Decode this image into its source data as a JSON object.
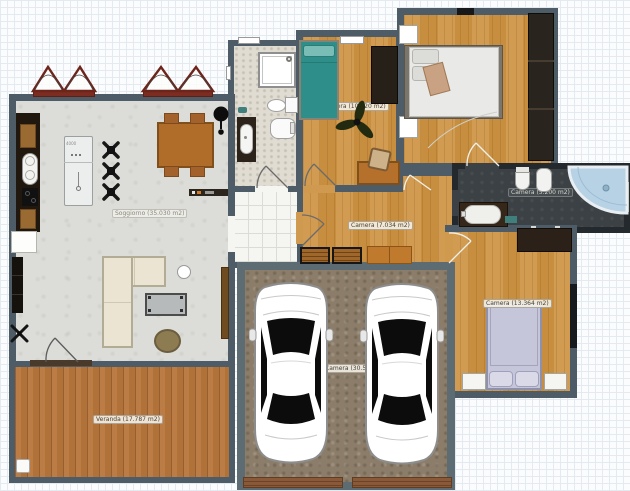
{
  "app": {
    "type": "floor-plan-canvas"
  },
  "labels": {
    "living": "Soggiorno (35.030 m2)",
    "veranda": "Veranda (17.787 m2)",
    "corridor": "Camera (7.034 m2)",
    "bedroom_middle": "Camera (10.020 m2)",
    "bathroom_main": "Camera (5.200 m2)",
    "bedroom_right": "Camera (13.364 m2)",
    "garage": "Camera (30.534 m2)",
    "island_dim": "4000"
  },
  "colors": {
    "wall": "#4d5c66",
    "wall_dark": "#23292c",
    "wall_garage": "#5d6b73",
    "floor_living": "#dcdcd8",
    "floor_wood": "#cf9a50",
    "floor_veranda": "#b87a42",
    "floor_garage": "#8b7d69",
    "floor_bath_dark": "#3b4144",
    "floor_bath_light": "#e0dcd2",
    "bed_teal": "#2e8e8a",
    "bed_lavender": "#c6c6da",
    "shower_blue": "#b7d2e5",
    "awning_red": "#7c2c20"
  }
}
